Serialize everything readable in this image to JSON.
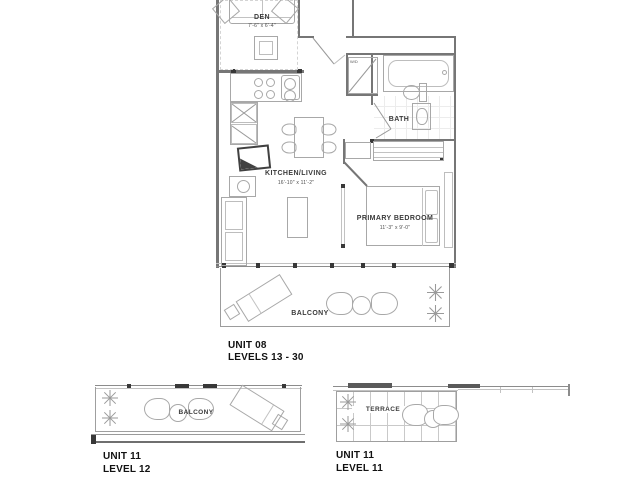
{
  "main_plan": {
    "den": {
      "label": "DEN",
      "dim": "7'-6\" x 6'-4\""
    },
    "kitchen_living": {
      "label": "KITCHEN/LIVING",
      "dim": "16'-10\" x 11'-2\""
    },
    "bath": {
      "label": "BATH"
    },
    "primary_bedroom": {
      "label": "PRIMARY BEDROOM",
      "dim": "11'-3\" x 9'-0\""
    },
    "balcony": {
      "label": "BALCONY"
    },
    "washer_dryer_label": "W/D",
    "caption": {
      "unit": "UNIT 08",
      "levels": "LEVELS 13 - 30"
    }
  },
  "level12_plan": {
    "balcony_label": "BALCONY",
    "caption": {
      "unit": "UNIT 11",
      "level": "LEVEL 12"
    }
  },
  "level11_plan": {
    "terrace_label": "TERRACE",
    "caption": {
      "unit": "UNIT 11",
      "level": "LEVEL 11"
    }
  },
  "colors": {
    "wall": "#767676",
    "line": "#8c8c8c",
    "furniture": "#a8a8a8",
    "marker": "#383838",
    "text": "#3b3b3b",
    "caption": "#111111"
  }
}
